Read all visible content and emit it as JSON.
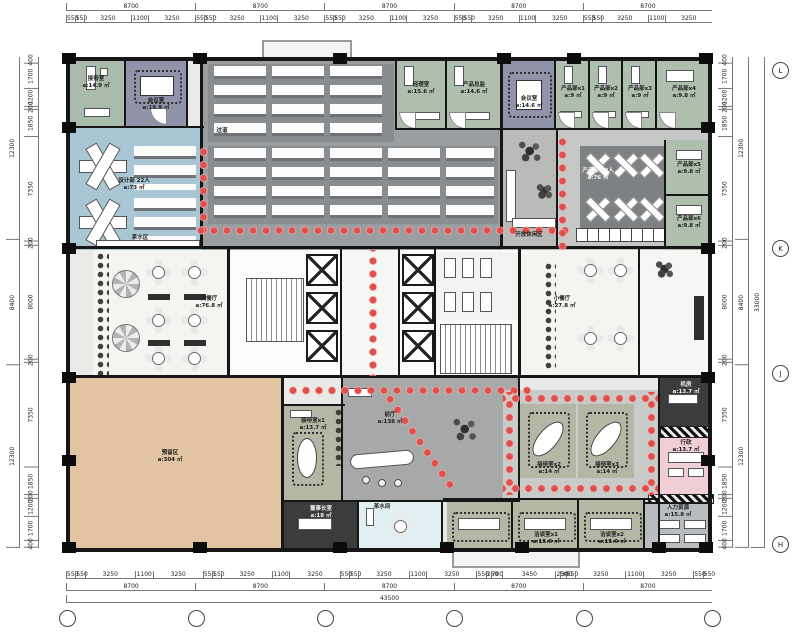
{
  "palette": {
    "dot_red": "#df4f4b",
    "wall_black": "#161616",
    "design_blue": "#a9c6d4",
    "meeting_purple": "#9193ab",
    "office_green": "#aebfae",
    "open_office_gray": "#8a8d90",
    "reserved_tan": "#e2c3a2",
    "hall_gray": "#a7a9a8",
    "reception_olive": "#b6b6a4",
    "admin_pink": "#f1ced5",
    "dark_room": "#3a3c3d",
    "pantry_cyan": "#e1eff2"
  },
  "plan": {
    "rooms": [
      {
        "label": "接待室",
        "area": "a:14.9 ㎡"
      },
      {
        "label": "会议室",
        "area": "a:19.9 ㎡"
      },
      {
        "label": "设计部 22人",
        "area": "a:73 ㎡"
      },
      {
        "label": "过道",
        "area": ""
      },
      {
        "label": "茶水区",
        "area": ""
      },
      {
        "label": "经理室",
        "area": "a:15.6 ㎡"
      },
      {
        "label": "产品总监",
        "area": "a:14.6 ㎡"
      },
      {
        "label": "会议室",
        "area": "a:14.6 ㎡"
      },
      {
        "label": "产品部x1",
        "area": "a:9 ㎡"
      },
      {
        "label": "产品部x2",
        "area": "a:9 ㎡"
      },
      {
        "label": "产品部x3",
        "area": "a:9 ㎡"
      },
      {
        "label": "产品部x4",
        "area": "a:9.8 ㎡"
      },
      {
        "label": "产品部x5",
        "area": "a:9.8 ㎡"
      },
      {
        "label": "产品部x6",
        "area": "a:9.8 ㎡"
      },
      {
        "label": "开放休闲区",
        "area": ""
      },
      {
        "label": "产品部 18人",
        "area": "a:76 ㎡"
      },
      {
        "label": "大餐厅",
        "area": "a:76.8 ㎡"
      },
      {
        "label": "小餐厅",
        "area": "a:27.8 ㎡"
      },
      {
        "label": "预留区",
        "area": "a:304 ㎡"
      },
      {
        "label": "前厅",
        "area": "a:138 ㎡"
      },
      {
        "label": "接待室x1",
        "area": "a:13.7 ㎡"
      },
      {
        "label": "接待室x2",
        "area": "a:14 ㎡"
      },
      {
        "label": "接待室x3",
        "area": "a:14 ㎡"
      },
      {
        "label": "机房",
        "area": "a:13.7 ㎡"
      },
      {
        "label": "行政",
        "area": "a:13.7 ㎡"
      },
      {
        "label": "人力资源",
        "area": "a:15.8 ㎡"
      },
      {
        "label": "董事长室",
        "area": "a:18 ㎡"
      },
      {
        "label": "茶水间",
        "area": ""
      },
      {
        "label": "洽谈室x1",
        "area": "a:15.6 ㎡"
      },
      {
        "label": "洽谈室x2",
        "area": "a:15.6 ㎡"
      }
    ]
  },
  "dims": {
    "top_majors": [
      "8700",
      "8700",
      "8700",
      "8700",
      "8700"
    ],
    "top_details": [
      "550",
      "550",
      "3250",
      "1100",
      "3250",
      "550",
      "550",
      "3250",
      "1100",
      "3250",
      "550",
      "550",
      "3250",
      "1100",
      "3250",
      "550",
      "550",
      "3250",
      "1100",
      "3250",
      "550",
      "550",
      "3250",
      "1100",
      "3250"
    ],
    "bottom_details": [
      "550",
      "550",
      "3250",
      "1100",
      "3250",
      "550",
      "550",
      "3250",
      "1100",
      "3250",
      "550",
      "550",
      "3250",
      "1100",
      "3250",
      "550",
      "250",
      "700",
      "3450",
      "250",
      "300",
      "550",
      "3250",
      "1100",
      "3250",
      "550",
      "550"
    ],
    "bottom_majors": [
      "8700",
      "8700",
      "8700",
      "8700",
      "8700"
    ],
    "bottom_total": [
      "43500"
    ],
    "left_details": [
      "400",
      "1700",
      "1200",
      "200",
      "1850",
      "7350",
      "200",
      "8000",
      "200",
      "7350",
      "1850",
      "200",
      "1200",
      "1700",
      "400"
    ],
    "left_majors": [
      "12300",
      "8400",
      "12300"
    ],
    "right_details": [
      "400",
      "1700",
      "1200",
      "200",
      "1850",
      "7350",
      "200",
      "8000",
      "200",
      "7350",
      "1850",
      "200",
      "1200",
      "1700",
      "400"
    ],
    "right_majors": [
      "12300",
      "8400",
      "12300"
    ],
    "right_total": [
      "33000"
    ],
    "axis_bottom": [
      "",
      "",
      "",
      "",
      "",
      ""
    ],
    "axis_right": [
      "L",
      "K",
      "J",
      "H"
    ]
  }
}
